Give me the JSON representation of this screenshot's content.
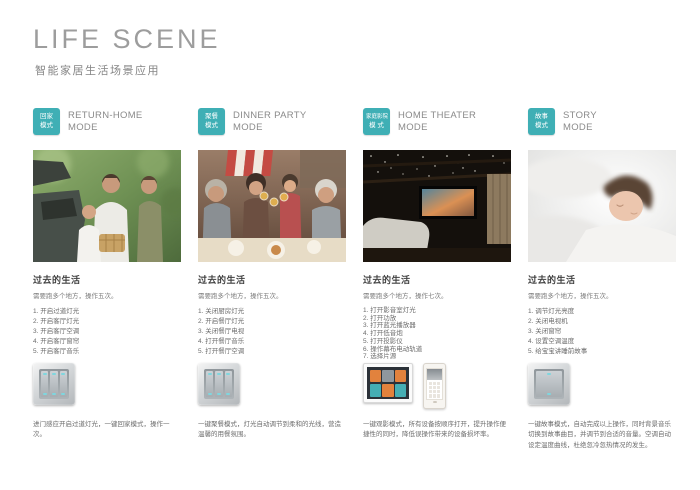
{
  "accent_color": "#3fafb5",
  "header": {
    "title": "LIFE SCENE",
    "subtitle": "智能家居生活场景应用"
  },
  "past_heading": "过去的生活",
  "columns": [
    {
      "badge_line1": "回家",
      "badge_line2": "模式",
      "title_line1": "RETURN-HOME",
      "title_line2": "MODE",
      "past_heading": "过去的生活",
      "past_subtitle": "需要跑多个地方，操作五次。",
      "steps": [
        "开启过道灯光",
        "开启客厅灯光",
        "开启客厅空调",
        "开启客厅窗帘",
        "开启客厅音乐"
      ],
      "photo_alt": "family-unloading-car-photo",
      "product": "three-gang-smart-switch",
      "description": "进门感应开启过道灯光，一键回家模式，操作一次。"
    },
    {
      "badge_line1": "聚餐",
      "badge_line2": "模式",
      "title_line1": "DINNER PARTY",
      "title_line2": "MODE",
      "past_heading": "过去的生活",
      "past_subtitle": "需要跑多个地方，操作五次。",
      "steps": [
        "关闭厨房灯光",
        "开启餐厅灯光",
        "关闭餐厅电视",
        "打开餐厅音乐",
        "打开餐厅空调"
      ],
      "photo_alt": "family-dinner-toast-photo",
      "product": "three-gang-smart-switch",
      "description": "一键聚餐模式，灯光自动调节到柔和的光线，营造温馨的用餐氛围。"
    },
    {
      "badge_line1": "家庭影院",
      "badge_line2": "模 式",
      "title_line1": "HOME THEATER",
      "title_line2": "MODE",
      "past_heading": "过去的生活",
      "past_subtitle": "需要跑多个地方，操作七次。",
      "steps": [
        "打开影音室灯光",
        "打开功放",
        "打开蓝光播放器",
        "打开低音炮",
        "打开投影仪",
        "操作幕布电动轨道",
        "选择片源"
      ],
      "photo_alt": "home-theater-room-photo",
      "product": "touchscreen-control-panel-and-smartphone-app",
      "description": "一键观影模式，所有设备按顺序打开，提升操作便捷性的同时，降低误操作带来的设备损坏率。"
    },
    {
      "badge_line1": "故事",
      "badge_line2": "模式",
      "title_line1": "STORY",
      "title_line2": "MODE",
      "past_heading": "过去的生活",
      "past_subtitle": "需要跑多个地方，操作五次。",
      "steps": [
        "调节灯光亮度",
        "关闭电视机",
        "关闭窗帘",
        "设置空调温度",
        "给宝宝讲睡前故事"
      ],
      "photo_alt": "sleeping-child-photo",
      "product": "one-gang-smart-switch",
      "description": "一键故事模式，自动完成以上操作，同时背景音乐切换到故事曲目，并调节到合适的音量。空调自动设定温度曲线，杜绝忽冷忽热情况的发生。"
    }
  ]
}
